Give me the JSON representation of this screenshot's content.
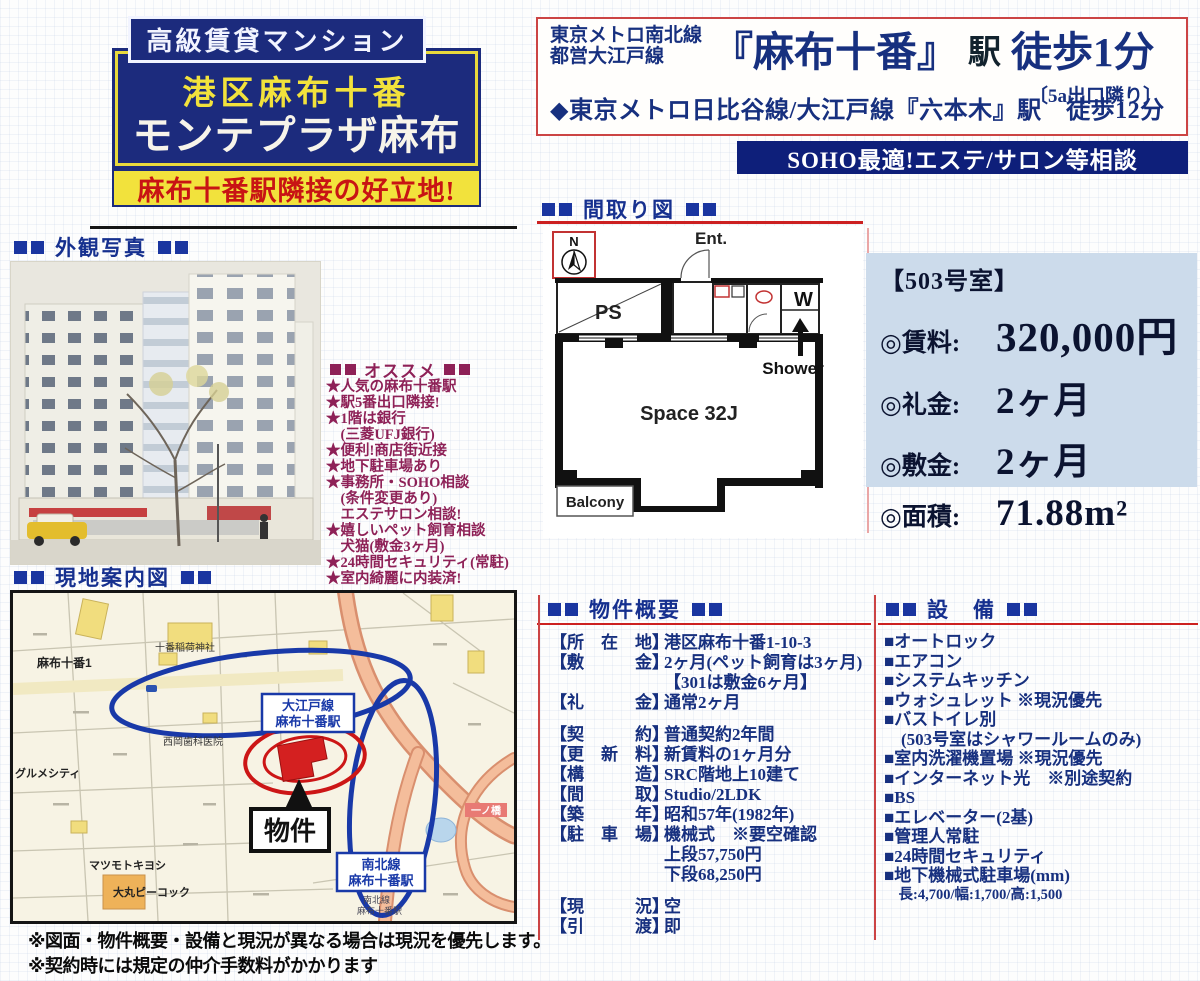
{
  "title_block": {
    "badge": "高級賃貸マンション",
    "subtitle": "港区麻布十番",
    "building_name": "モンテプラザ麻布",
    "highlight": "麻布十番駅隣接の好立地!"
  },
  "access": {
    "line_small_1": "東京メトロ南北線",
    "line_small_2": "都営大江戸線",
    "station_big": "『麻布十番』",
    "station_suffix": "駅",
    "walk_big": "徒歩1分",
    "exit_note": "〔5a出口隣り〕",
    "second_line": "◆東京メトロ日比谷線/大江戸線『六本木』駅　徒歩12分",
    "banner": "SOHO最適!エステ/サロン等相談"
  },
  "sections": {
    "photo_header": "外観写真",
    "floorplan_header": "間取り図",
    "map_header": "現地案内図",
    "overview_header": "物件概要",
    "facilities_header": "設　備",
    "recommend_header": "オススメ"
  },
  "recommend": {
    "lines": [
      "★人気の麻布十番駅",
      "★駅5番出口隣接!",
      "★1階は銀行",
      "　(三菱UFJ銀行)",
      "★便利!商店街近接",
      "★地下駐車場あり",
      "★事務所・SOHO相談",
      "　(条件変更あり)",
      "　エステサロン相談!",
      "★嬉しいペット飼育相談",
      "　犬猫(敷金3ヶ月)",
      "★24時間セキュリティ(常駐)",
      "★室内綺麗に内装済!"
    ]
  },
  "floorplan": {
    "labels": {
      "north": "N",
      "ent": "Ent.",
      "ps": "PS",
      "w": "W",
      "shower": "Shower",
      "space": "Space 32J",
      "balcony": "Balcony"
    }
  },
  "room": {
    "number": "【503号室】",
    "rows": [
      {
        "label": "◎賃料:",
        "value": "320,000円"
      },
      {
        "label": "◎礼金:",
        "value": "2ヶ月"
      },
      {
        "label": "◎敷金:",
        "value": "2ヶ月"
      },
      {
        "label": "◎面積:",
        "value": "71.88m²"
      }
    ]
  },
  "map": {
    "labels": {
      "area": "麻布十番1",
      "shrine": "十番稲荷神社",
      "dental": "西岡歯科医院",
      "gourmet": "グルメシティ",
      "matsumoto": "マツモトキヨシ",
      "daimaru": "大丸ピーコック",
      "bridge": "一ノ橋",
      "station_oedo_1": "大江戸線",
      "station_oedo_2": "麻布十番駅",
      "station_namboku_1": "南北線",
      "station_namboku_2": "麻布十番駅",
      "station_namboku_small_1": "南北線",
      "station_namboku_small_2": "麻布十番駅",
      "property": "物件"
    }
  },
  "overview": {
    "rows": [
      {
        "label": "【所　在　地】",
        "value": "港区麻布十番1-10-3"
      },
      {
        "label": "【敷　　　金】",
        "value": "2ヶ月(ペット飼育は3ヶ月)"
      },
      {
        "label": "",
        "value": "【301は敷金6ヶ月】"
      },
      {
        "label": "【礼　　　金】",
        "value": "通常2ヶ月"
      },
      {
        "label": "【契　　　約】",
        "value": "普通契約2年間"
      },
      {
        "label": "【更　新　料】",
        "value": "新賃料の1ヶ月分"
      },
      {
        "label": "【構　　　造】",
        "value": "SRC階地上10建て"
      },
      {
        "label": "【間　　　取】",
        "value": "Studio/2LDK"
      },
      {
        "label": "【築　　　年】",
        "value": "昭和57年(1982年)"
      },
      {
        "label": "【駐　車　場】",
        "value": "機械式　※要空確認"
      },
      {
        "label": "",
        "value": "上段57,750円"
      },
      {
        "label": "",
        "value": "下段68,250円"
      },
      {
        "label": "【現　　　況】",
        "value": "空"
      },
      {
        "label": "【引　　　渡】",
        "value": "即"
      }
    ]
  },
  "facilities": {
    "items": [
      "■オートロック",
      "■エアコン",
      "■システムキッチン",
      "■ウォシュレット ※現況優先",
      "■バストイレ別",
      "　(503号室はシャワールームのみ)",
      "■室内洗濯機置場 ※現況優先",
      "■インターネット光　※別途契約",
      "■BS",
      "■エレベーター(2基)",
      "■管理人常駐",
      "■24時間セキュリティ",
      "■地下機械式駐車場(mm)",
      "　長:4,700/幅:1,700/高:1,500"
    ]
  },
  "notes": {
    "line1": "※図面・物件概要・設備と現況が異なる場合は現況を優先します。",
    "line2": "※契約時には規定の仲介手数料がかかります"
  }
}
